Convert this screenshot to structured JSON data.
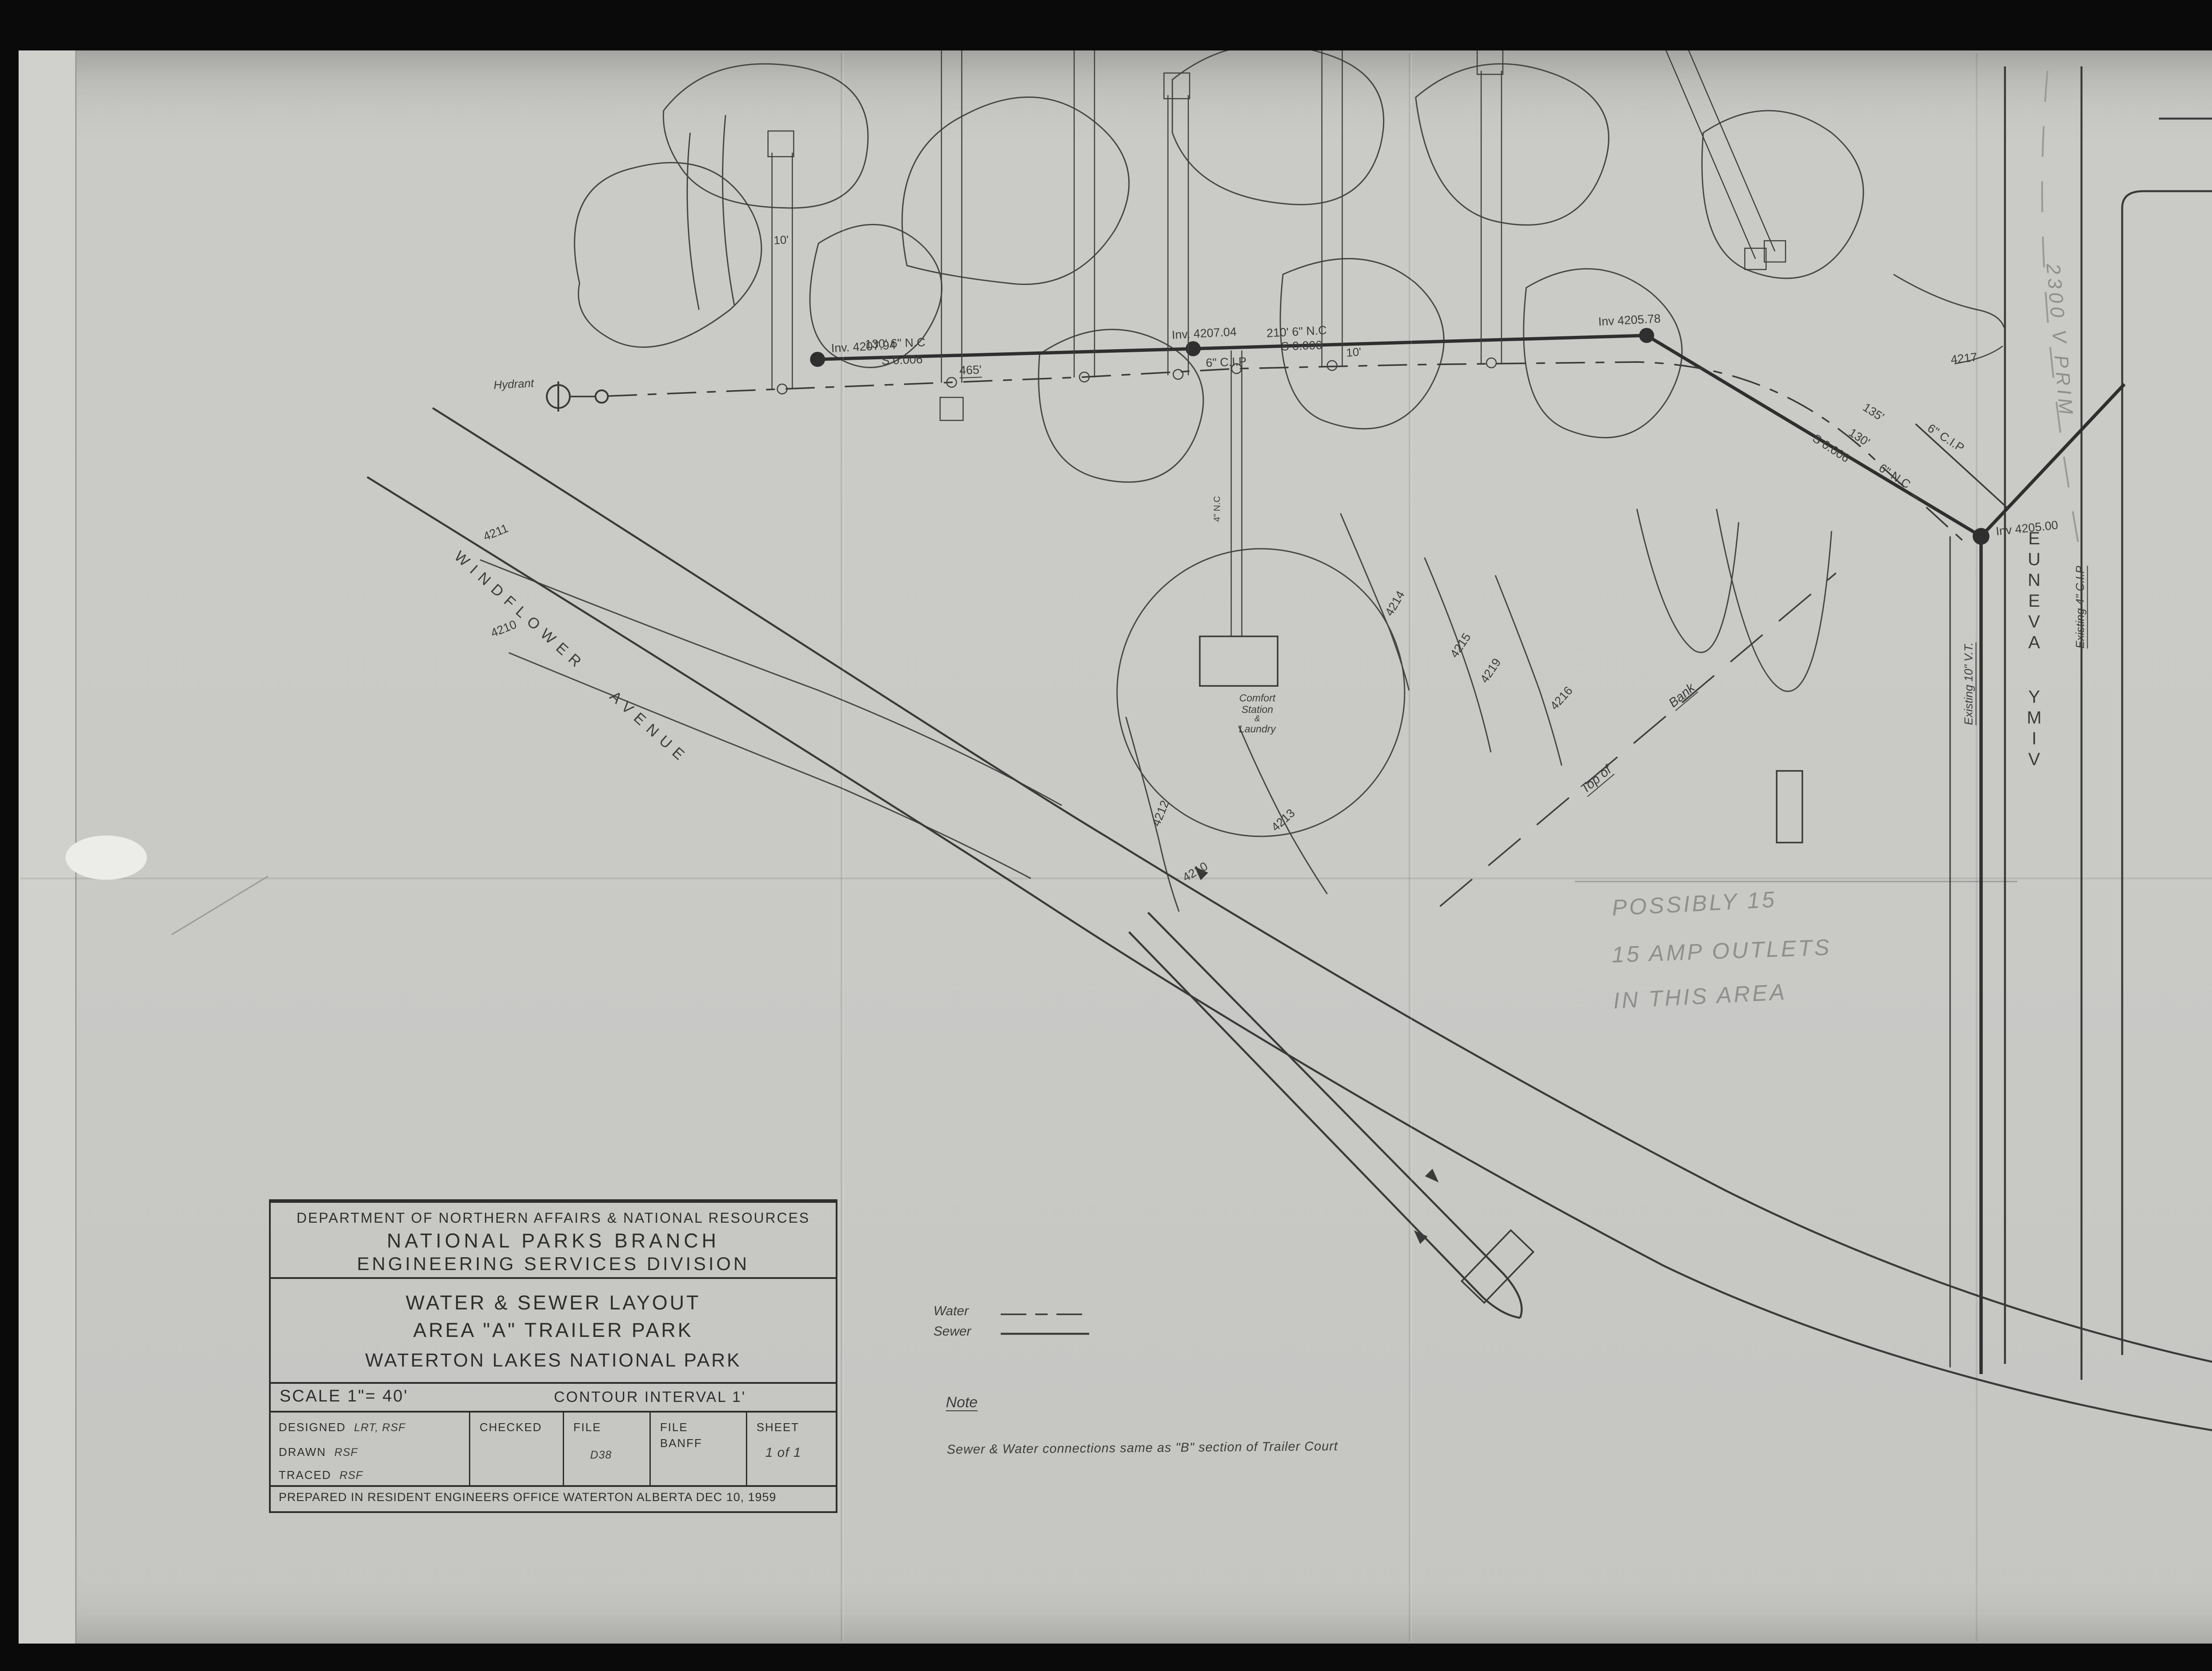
{
  "film": {
    "frame_number": "000112",
    "page_stamp": "2 of/de 2",
    "labels": {
      "reference_line1": "RG 84, A-2-a, vol. 2204",
      "reference_line2": "File/dossier W36 Plans",
      "reference_line3": "pt 2",
      "agency_line1": "Parks Canada",
      "agency_line2": "Parcs Canada",
      "archive_line1": "National Archives of Canada",
      "archive_line2": "Archives nationales du Canada"
    }
  },
  "title_block": {
    "department": "DEPARTMENT OF NORTHERN AFFAIRS & NATIONAL RESOURCES",
    "branch": "NATIONAL PARKS BRANCH",
    "division": "ENGINEERING SERVICES DIVISION",
    "project_line1": "WATER & SEWER LAYOUT",
    "project_line2": "AREA \"A\" TRAILER PARK",
    "project_line3": "WATERTON LAKES NATIONAL PARK",
    "scale": "SCALE 1\"= 40'",
    "contour_interval": "CONTOUR INTERVAL 1'",
    "designed_label": "DESIGNED",
    "designed_value": "LRT, RSF",
    "drawn_label": "DRAWN",
    "drawn_value": "RSF",
    "traced_label": "TRACED",
    "traced_value": "RSF",
    "checked_label": "CHECKED",
    "file_label": "FILE",
    "file_value": "D38",
    "file_banff_line1": "FILE",
    "file_banff_line2": "BANFF",
    "sheet_label": "SHEET",
    "sheet_value": "1 of 1",
    "prepared": "PREPARED IN RESIDENT ENGINEERS OFFICE   WATERTON ALBERTA   DEC 10, 1959"
  },
  "legend": {
    "water": "Water",
    "sewer": "Sewer"
  },
  "note": {
    "heading": "Note",
    "body": "Sewer & Water connections  same as \"B\" section of Trailer Court"
  },
  "pencil_notes": {
    "outlets_line1": "POSSIBLY 15",
    "outlets_line2": "15 AMP OUTLETS",
    "outlets_line3": "IN THIS AREA",
    "power": "2300 V  PRIM"
  },
  "streets": {
    "windflower": "WINDFLOWER AVENUE",
    "vimy": "VIMY AVENUE"
  },
  "map_labels": {
    "hydrant": "Hydrant",
    "comfort_line1": "Comfort",
    "comfort_line2": "Station",
    "comfort_line3": "&",
    "comfort_line4": "Laundry",
    "top_of_bank_a": "Top of",
    "top_of_bank_b": "Bank",
    "inv_1": "Inv. 4207.94",
    "inv_2": "Inv. 4207.04",
    "inv_3": "Inv 4205.78",
    "inv_4": "Inv 4205.00",
    "run1_dim": "130'   6\" N.C",
    "run1_grade": "S 0.006",
    "run2_dim": "210'   6\" N.C",
    "run2_grade": "S 0.006",
    "run3_dim_a": "135'",
    "run3_dim_b": "130'",
    "run3_grade": "S 0.006",
    "run3_pipe": "6\" N.C",
    "water_main_pipe": "6\" C.I.P",
    "water_branch_pipe": "6\" C.I.P",
    "water_dim": "465'",
    "dim_a": "10'",
    "dim_b": "10'",
    "existing_vt": "Existing 10\" V.T.",
    "existing_cip": "Existing 4\" C.I.P",
    "service_pipe": "4\" N.C",
    "contours": [
      "4211",
      "4210",
      "4212",
      "4213",
      "4210",
      "4214",
      "4215",
      "4219",
      "4216",
      "4217"
    ]
  }
}
